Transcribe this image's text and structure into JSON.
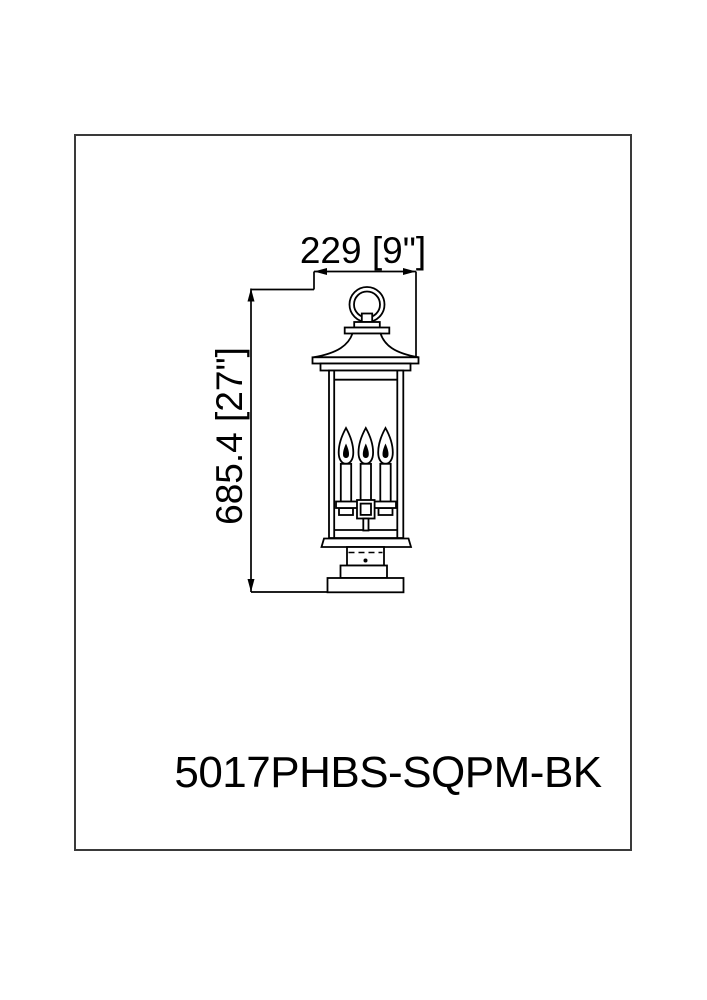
{
  "page": {
    "background": "#ffffff",
    "border_color": "#3a3a3a",
    "line_color": "#000000"
  },
  "drawing": {
    "width_dimension_label": "229 [9\"]",
    "height_dimension_label": "685.4 [27\"]",
    "model_number": "5017PHBS-SQPM-BK",
    "dimensions": {
      "width_mm": 229,
      "width_inches": 9,
      "height_mm": 685.4,
      "height_inches": 27
    },
    "fixture": {
      "candle_count": 3
    }
  }
}
